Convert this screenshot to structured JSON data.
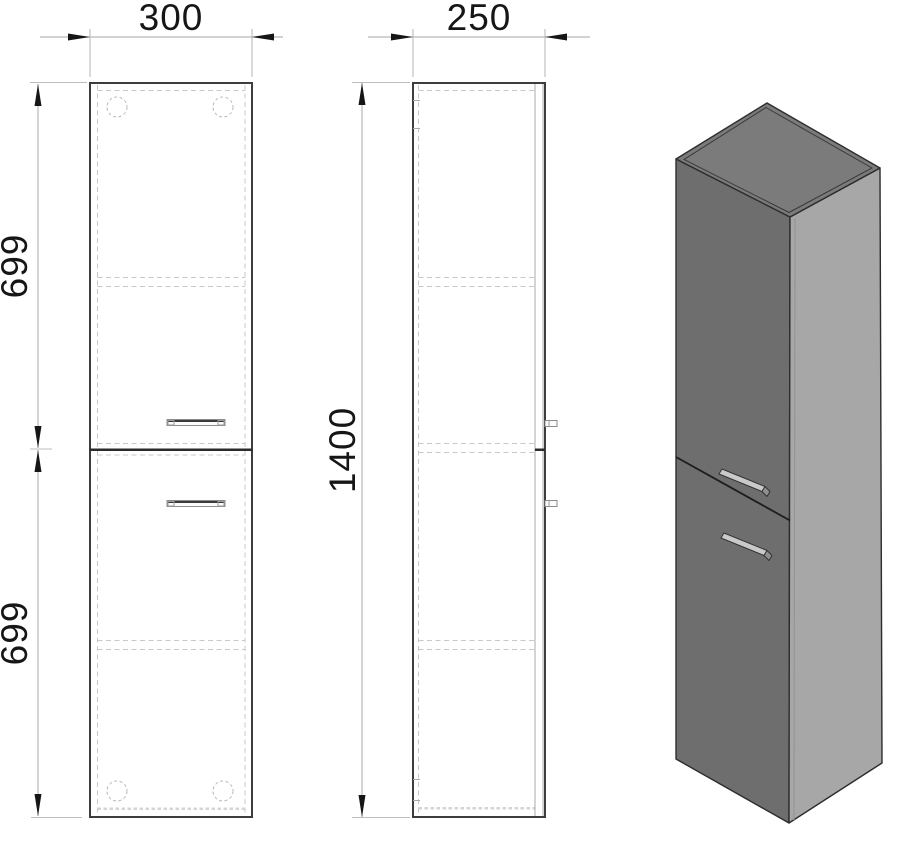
{
  "dimensions": {
    "width_label": "300",
    "depth_label": "250",
    "height_label": "1400",
    "upper_height_label": "699",
    "lower_height_label": "699"
  },
  "colors": {
    "line_dark": "#3d3d3d",
    "hidden_line": "#c8c8c8",
    "dim_line": "#b8b8b8",
    "dim_text": "#161616",
    "iso_front": "#6e6e6e",
    "iso_top": "#7b7b7b",
    "iso_side": "#a7a7a7",
    "iso_edge": "#2d2d2d",
    "handle_light": "#c9c9c9",
    "handle_dark": "#909090"
  }
}
